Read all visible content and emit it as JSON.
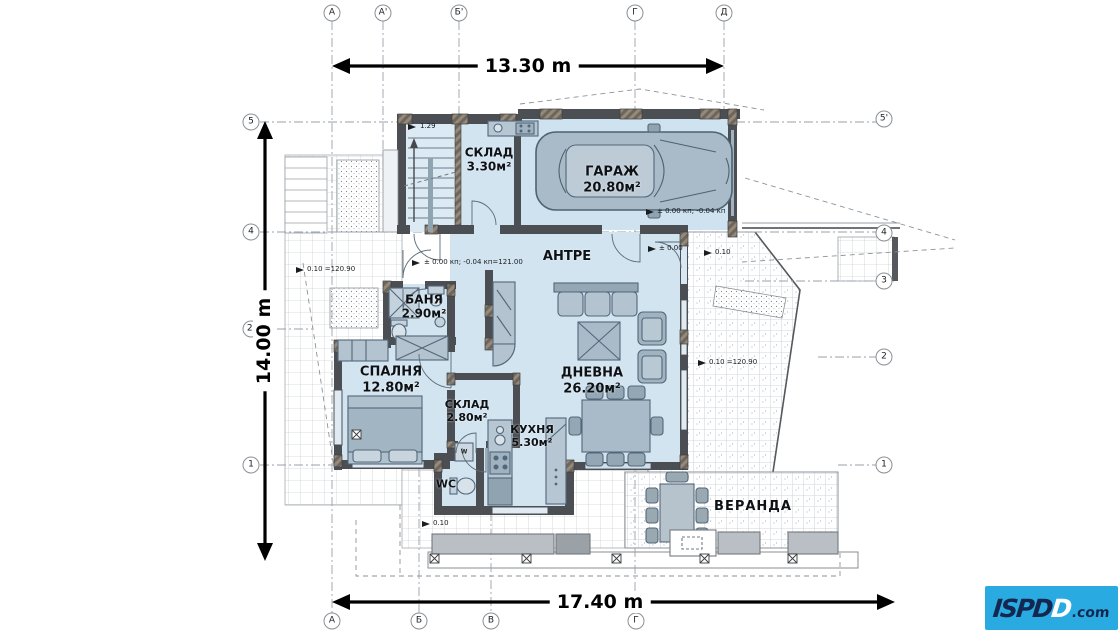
{
  "dimensions": {
    "top": "13.30 m",
    "left": "14.00 m",
    "bottom": "17.40 m"
  },
  "grid": {
    "top": [
      {
        "label": "А"
      },
      {
        "label": "А'"
      },
      {
        "label": "Б'"
      },
      {
        "label": "Г"
      },
      {
        "label": "Д"
      }
    ],
    "bottom": [
      {
        "label": "А"
      },
      {
        "label": "Б"
      },
      {
        "label": "В"
      },
      {
        "label": "Г"
      }
    ],
    "left": [
      {
        "label": "5"
      },
      {
        "label": "4"
      },
      {
        "label": "2'"
      },
      {
        "label": "1"
      }
    ],
    "right": [
      {
        "label": "5'"
      },
      {
        "label": "4"
      },
      {
        "label": "3"
      },
      {
        "label": "2"
      },
      {
        "label": "1"
      }
    ]
  },
  "rooms": {
    "sklad1": {
      "name": "СКЛАД",
      "area": "3.30м²"
    },
    "garage": {
      "name": "ГАРАЖ",
      "area": "20.80м²"
    },
    "antre": {
      "name": "АНТРЕ"
    },
    "banya": {
      "name": "БАНЯ",
      "area": "2.90м²"
    },
    "spalnya": {
      "name": "СПАЛНЯ",
      "area": "12.80м²"
    },
    "sklad2": {
      "name": "СКЛАД",
      "area": "2.80м²"
    },
    "kuhnya": {
      "name": "КУХНЯ",
      "area": "5.30м²"
    },
    "dnevna": {
      "name": "ДНЕВНА",
      "area": "26.20м²"
    },
    "wc": {
      "name": "WC"
    },
    "veranda": {
      "name": "ВЕРАНДА"
    }
  },
  "annotations": {
    "stairs_level": "1.29",
    "entry_level": "± 0.00 кп; -0.04 кп=121.00",
    "terrace_left_level": "0.10 =120.90",
    "garage_level": "± 0.00 кп; -0.04 кп",
    "porch_level_a": "± 0.00",
    "porch_level_b": "0.10",
    "terrace_right_level": "0.10 =120.90",
    "walk_level": "0.10",
    "washer": "W"
  },
  "logo": {
    "part1": "ISPD",
    "part2": "D",
    "suffix": ".com"
  },
  "colors": {
    "accent_logo": "#29abe2",
    "room_fill": "#d2e4f0",
    "wall": "#4b4e52"
  }
}
